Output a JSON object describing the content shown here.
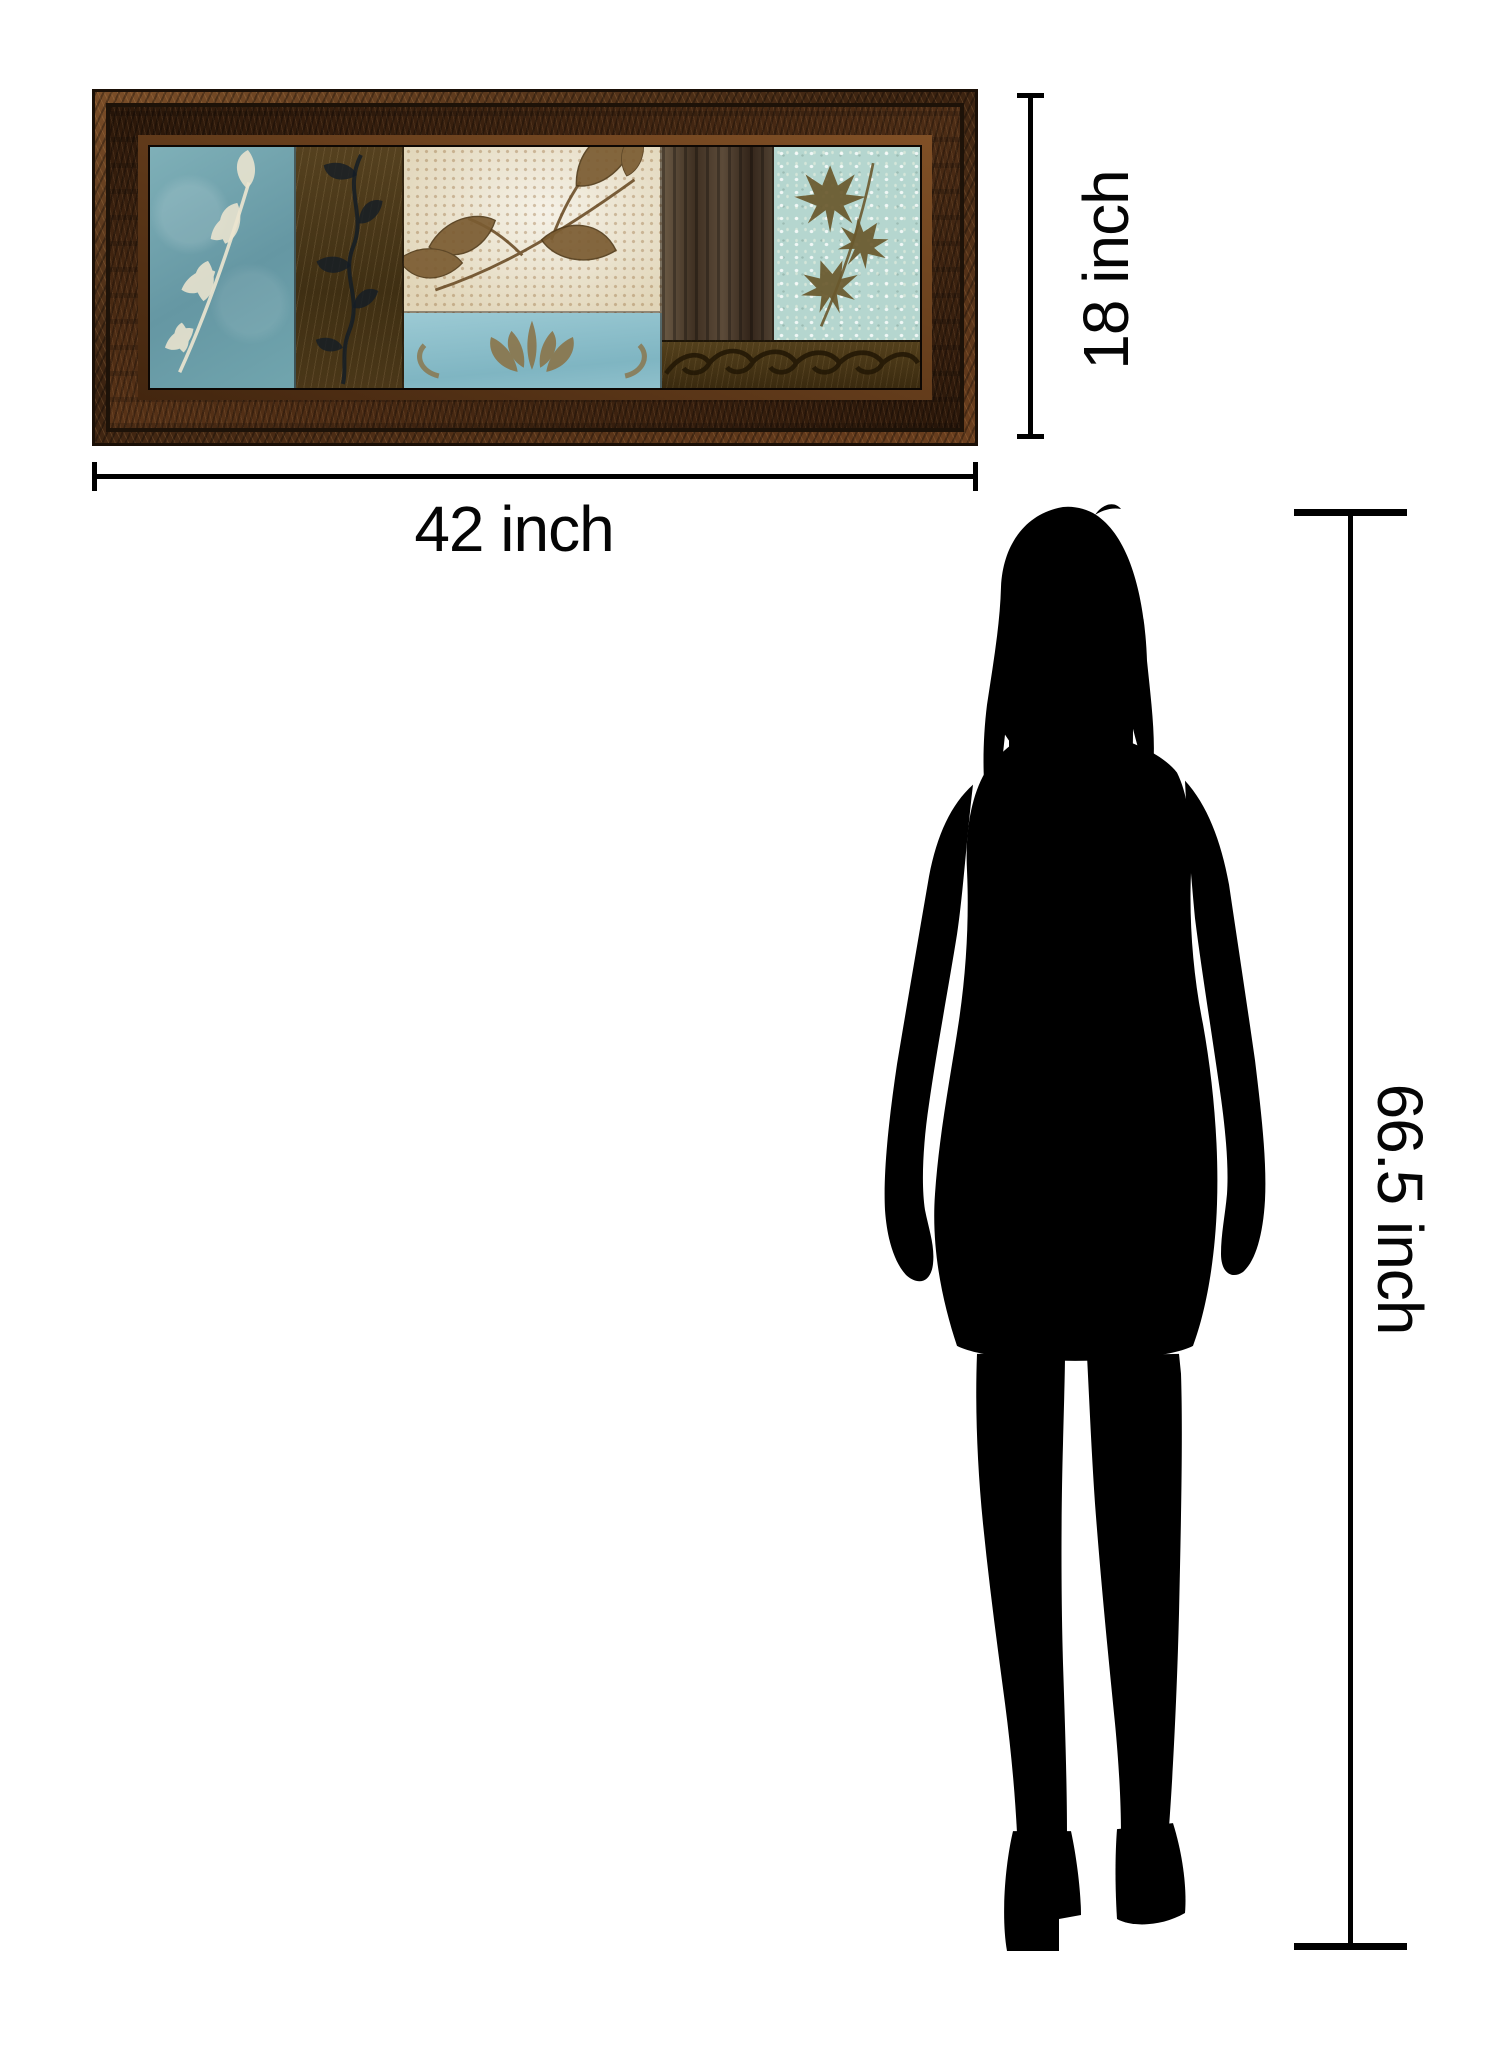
{
  "scene": {
    "background_color": "#ffffff",
    "description": "Product size comparison graphic: framed leaf-collage wall art with dimension lines and a woman silhouette for scale"
  },
  "artwork": {
    "name": "leaf-collage-framed-art",
    "frame_color": "#4e2d15",
    "panel_colors": {
      "blue_leaf_panel": "#74a4ad",
      "brown_flourish_panel": "#4c3a1b",
      "cream_leaves_panel": "#e9e1cb",
      "blue_damask_panel": "#8fc0cb",
      "wood_grain_panel": "#4a3a2a",
      "teal_maple_panel": "#b5d6cf",
      "scroll_band_panel": "#443114"
    },
    "leaf_print_color": "#ece5d0",
    "brown_leaf_color": "#7b5c32",
    "damask_motif_color": "#8a7347"
  },
  "dimensions": {
    "line_color": "#000000",
    "width": {
      "label": "42 inch"
    },
    "height": {
      "label": "18 inch"
    },
    "person_height": {
      "label": "66.5 inch"
    }
  },
  "figure": {
    "name": "woman-silhouette",
    "color": "#000000"
  }
}
